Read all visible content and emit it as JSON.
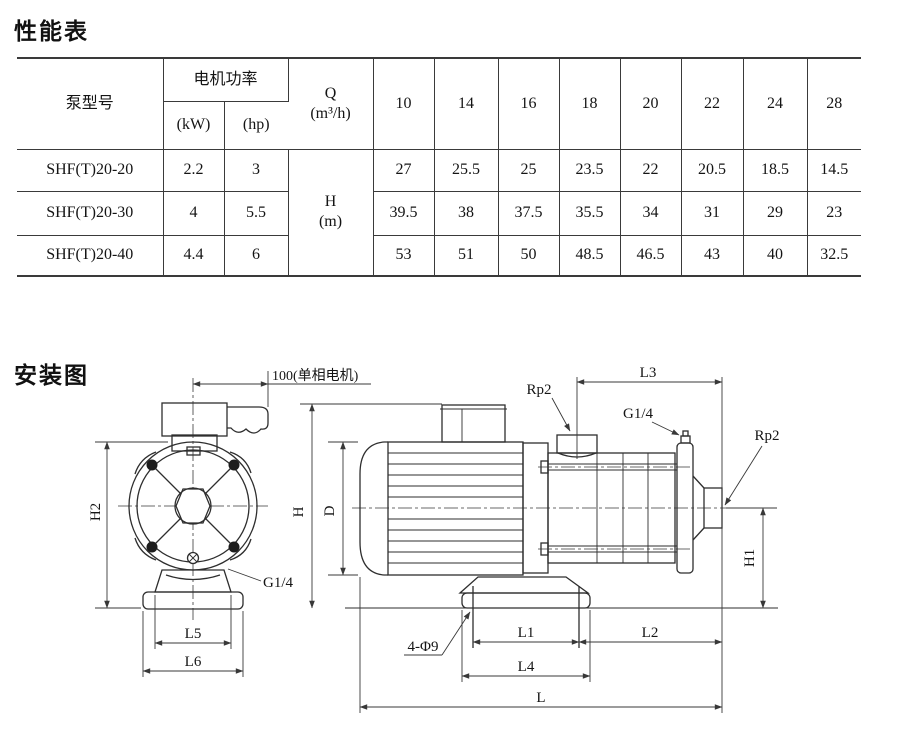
{
  "performance": {
    "title": "性能表",
    "table": {
      "col_model": "泵型号",
      "col_power": "电机功率",
      "col_kw": "(kW)",
      "col_hp": "(hp)",
      "col_q": "Q\n(m³/h)",
      "col_h": "H\n(m)",
      "flow_values": [
        "10",
        "14",
        "16",
        "18",
        "20",
        "22",
        "24",
        "28"
      ],
      "rows": [
        {
          "model": "SHF(T)20-20",
          "kw": "2.2",
          "hp": "3",
          "heads": [
            "27",
            "25.5",
            "25",
            "23.5",
            "22",
            "20.5",
            "18.5",
            "14.5"
          ]
        },
        {
          "model": "SHF(T)20-30",
          "kw": "4",
          "hp": "5.5",
          "heads": [
            "39.5",
            "38",
            "37.5",
            "35.5",
            "34",
            "31",
            "29",
            "23"
          ]
        },
        {
          "model": "SHF(T)20-40",
          "kw": "4.4",
          "hp": "6",
          "heads": [
            "53",
            "51",
            "50",
            "48.5",
            "46.5",
            "43",
            "40",
            "32.5"
          ]
        }
      ]
    }
  },
  "installation": {
    "title": "安装图",
    "labels": {
      "motor_dim": "100(单相电机)",
      "h2": "H2",
      "g14_left": "G1/4",
      "l5": "L5",
      "l6": "L6",
      "h": "H",
      "d": "D",
      "rp2_top": "Rp2",
      "l3": "L3",
      "g14_right": "G1/4",
      "rp2_right": "Rp2",
      "h1": "H1",
      "bolt_holes": "4-Φ9",
      "l1": "L1",
      "l2": "L2",
      "l4": "L4",
      "l": "L"
    }
  }
}
